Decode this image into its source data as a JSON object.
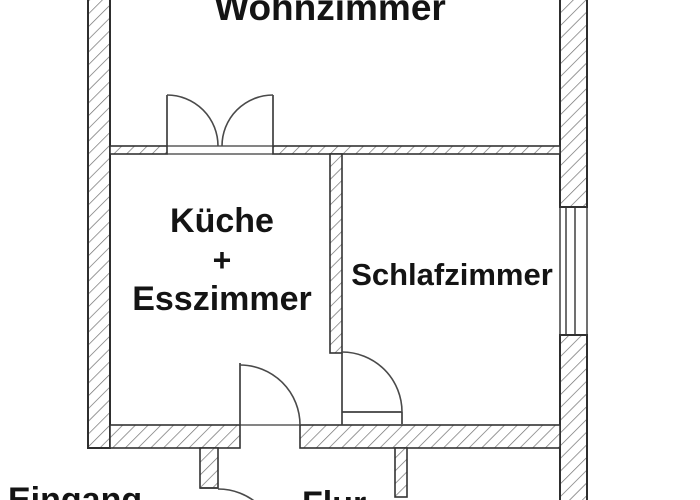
{
  "labels": {
    "wohnzimmer": "Wohnzimmer",
    "kueche": "Küche",
    "plus": "+",
    "esszimmer": "Esszimmer",
    "schlafzimmer": "Schlafzimmer",
    "eingang": "Eingang",
    "flur": "Flur"
  },
  "colors": {
    "background": "#ffffff",
    "wall_outline": "#2e2e2e",
    "hatch_line": "#707070",
    "door_line": "#4a4a4a",
    "text": "#141414"
  }
}
